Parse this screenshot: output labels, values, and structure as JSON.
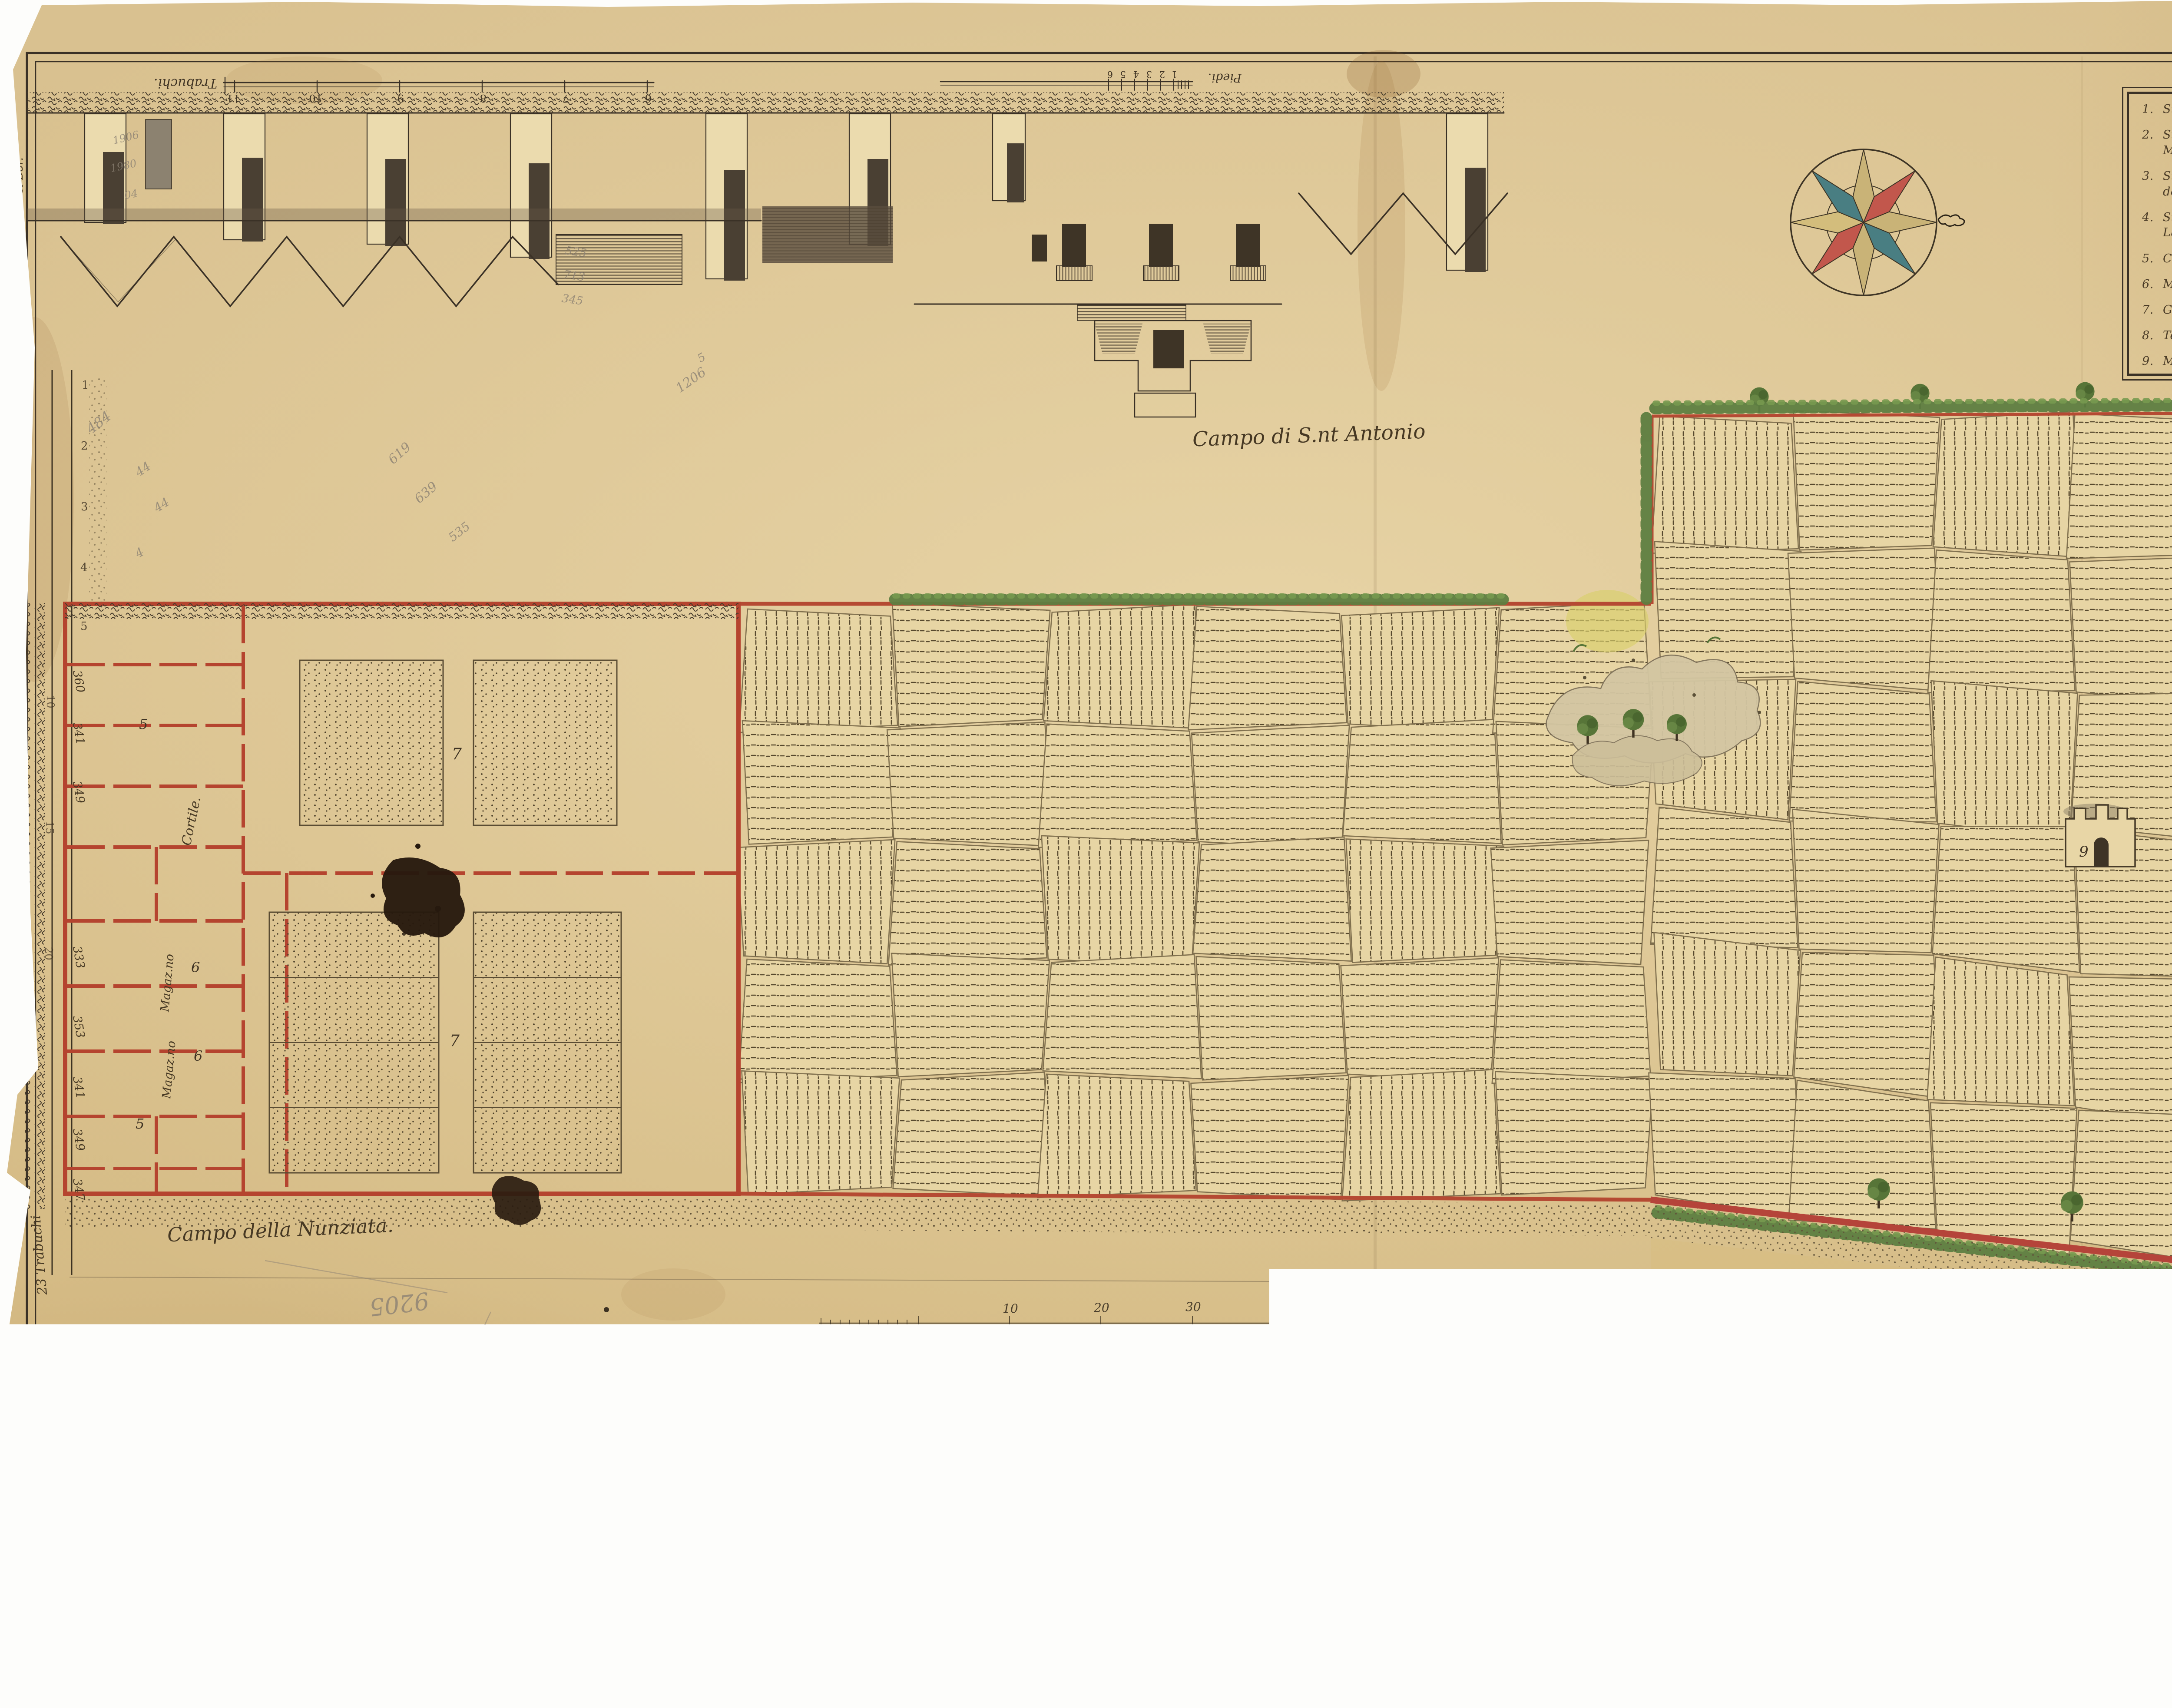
{
  "header": {
    "title": "PIANTA DEL POSESSO CHE HA COMPRATO L'ILL.MO SIG.OR MARCHESE DI LACONI NOMINATO SU BRUGHIXEDDU IN ISTAMPACE"
  },
  "legend": {
    "items": [
      {
        "num": "1.",
        "text": "Strada del Bor."
      },
      {
        "num": "2.",
        "text": "Strada che divide fra il posesso dell'Ill.mo Sig.r Marchese di Laconi ed il Campo della Nunziata."
      },
      {
        "num": "3.",
        "text": "Strada che conduce alle fornace ed al Convento dei Cappucini"
      },
      {
        "num": "4.",
        "text": "Strada del Giardino dell'Ill.mo Sig.r Marchese di Laconi"
      },
      {
        "num": "5.",
        "text": "Case di affitare."
      },
      {
        "num": "6.",
        "text": "Magazzeni per grani."
      },
      {
        "num": "7.",
        "text": "Giardini"
      },
      {
        "num": "8.",
        "text": "Terreno coltivato"
      },
      {
        "num": "9.",
        "text": "Molino d'aqua"
      }
    ]
  },
  "labels": {
    "campo_antonio": "Campo di S.nt Antonio",
    "campo_nunziata": "Campo della Nunziata.",
    "campo_marchese": "Campo del Marchese di S.n Sperato",
    "cortile": "Cortile.",
    "magazzino_a": "Magaz.no",
    "magazzino_b": "Magaz.no",
    "strada_bor_side": "Strada del Bor.",
    "trabuchi_23": "23 Trabuchi"
  },
  "scales": {
    "trabuchi": {
      "label": "Trabuchi.",
      "ticks": [
        "11",
        "10",
        "9",
        "8",
        "7",
        "6"
      ]
    },
    "piedi": {
      "label": "Piedi.",
      "ticks": [
        "6",
        "5",
        "4",
        "3",
        "2",
        "1"
      ]
    },
    "metri": {
      "ticks": [
        "10",
        "20",
        "30",
        "40",
        "50"
      ],
      "unit": "metr."
    }
  },
  "map_numbers": {
    "gardens_upper": "7",
    "gardens_lower": "7",
    "magazzino_a": "6",
    "magazzino_b": "6",
    "case_upper": "5",
    "case_lower": "5",
    "mill": "9",
    "road_right": "3",
    "street_numbers": [
      "360",
      "341",
      "349",
      "333",
      "353",
      "341",
      "349",
      "347"
    ],
    "road_marks": [
      "1",
      "2",
      "3",
      "4",
      "5",
      "10",
      "15",
      "20"
    ]
  },
  "pencil_notes": [
    "484",
    "44",
    "44",
    "4",
    "619",
    "639",
    "535",
    "525",
    "713",
    "345",
    "1206",
    "5",
    "1906",
    "1980",
    "04",
    "9205",
    "1295",
    "37",
    "36,4",
    "35"
  ],
  "colors": {
    "paper": "#d8c08c",
    "ink": "#3f3323",
    "accent_red": "#b54a33",
    "hedge_green": "#5e7e41",
    "compass_teal": "#497e82",
    "compass_red": "#c2574c",
    "compass_tan": "#c9b377",
    "pencil": "#8b8173"
  }
}
